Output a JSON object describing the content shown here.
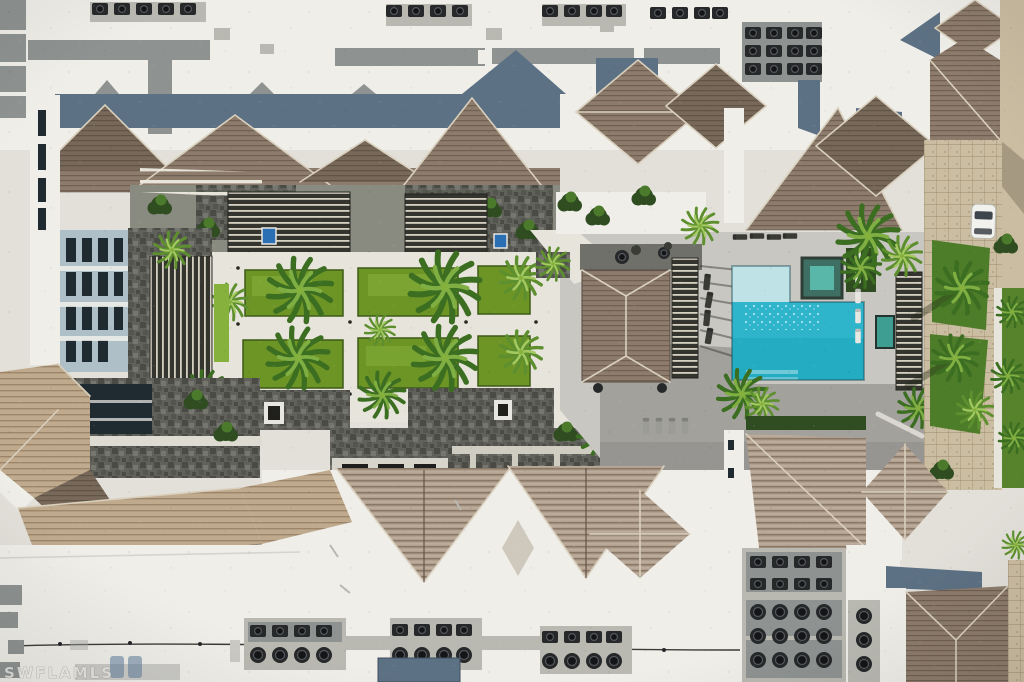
{
  "image": {
    "type": "aerial-photograph",
    "subject": "top-down drone view of a residential condo complex with courtyard lawns, palm trees, an L-shaped swimming pool with spa, brown shingled hip roofs and white flat roofs with rooftop AC equipment",
    "width_px": 1024,
    "height_px": 682
  },
  "watermark": {
    "text": "SWFLAMLS"
  },
  "palette": {
    "roof_white": "#efeee9",
    "roof_white_dim": "#e2e0d9",
    "pad": "#8e9392",
    "pad_light": "#b9b8b1",
    "ac": "#26282a",
    "shingle": "#8d7c6c",
    "shingle_dark": "#776859",
    "shingle_tan": "#c0aa8d",
    "shingle_pink": "#b2a08f",
    "ridge_light": "#d9cfbd",
    "ridge_dark": "#5a4c40",
    "slate": "#5d7184",
    "concrete": "#e7e4db",
    "stone": "#60615a",
    "stone_dark": "#4a4b44",
    "stone_light": "#75766d",
    "slat_dark": "#35352f",
    "slat_light": "#d6d0c2",
    "wall_blue": "#aebfc8",
    "window": "#1f2a31",
    "lawn": "#6d9526",
    "lawn_light": "#86b13c",
    "lawn_dark": "#4e7d2a",
    "palm_dark": "#3c6e22",
    "palm_light": "#7fae43",
    "palm_mid": "#5d8f2f",
    "palm_lighter": "#a4c960",
    "tree": "#2f4d20",
    "tree_light": "#4c7a2c",
    "pool": "#2fb5cb",
    "pool_deep": "#22a9c0",
    "pool_light": "#bfe2e6",
    "spa": "#58b7a8",
    "spa_frame": "#3f6f63",
    "deck": "#c9c7c1",
    "deck_dark": "#a2a19c",
    "paver": "#cbbda2",
    "grass_edge": "#57832d",
    "car": "#f1f1ee"
  },
  "scene": {
    "regions": {
      "north_flat_roof": "white flat roof with walkway pads and AC condensers",
      "north_building_roofs": "brown shingled gable and hip roofs with slate-blue rear slopes",
      "courtyard": "grid of hedged lawn squares, concrete paths, palms, stone patios, slatted pergolas and two blue water features",
      "pool_area": "gray pool deck, L-shaped pool with tanning shelf, green spa, clubhouse pavilion with hip roof and pergola",
      "east_drive": "paver driveway with lawn islands, palms and a parked white car",
      "south_building_roofs": "ridged tan chevron roofs and hip pyramids",
      "south_flat_roof": "large white roof with three AC clusters and equipment farm",
      "southeast_building": "hip roof building with slate flat section"
    },
    "objects": {
      "pools": 1,
      "spas": 1,
      "parked_cars": 1,
      "courtyard_lawn_squares": 6,
      "blue_water_features": 2
    }
  }
}
